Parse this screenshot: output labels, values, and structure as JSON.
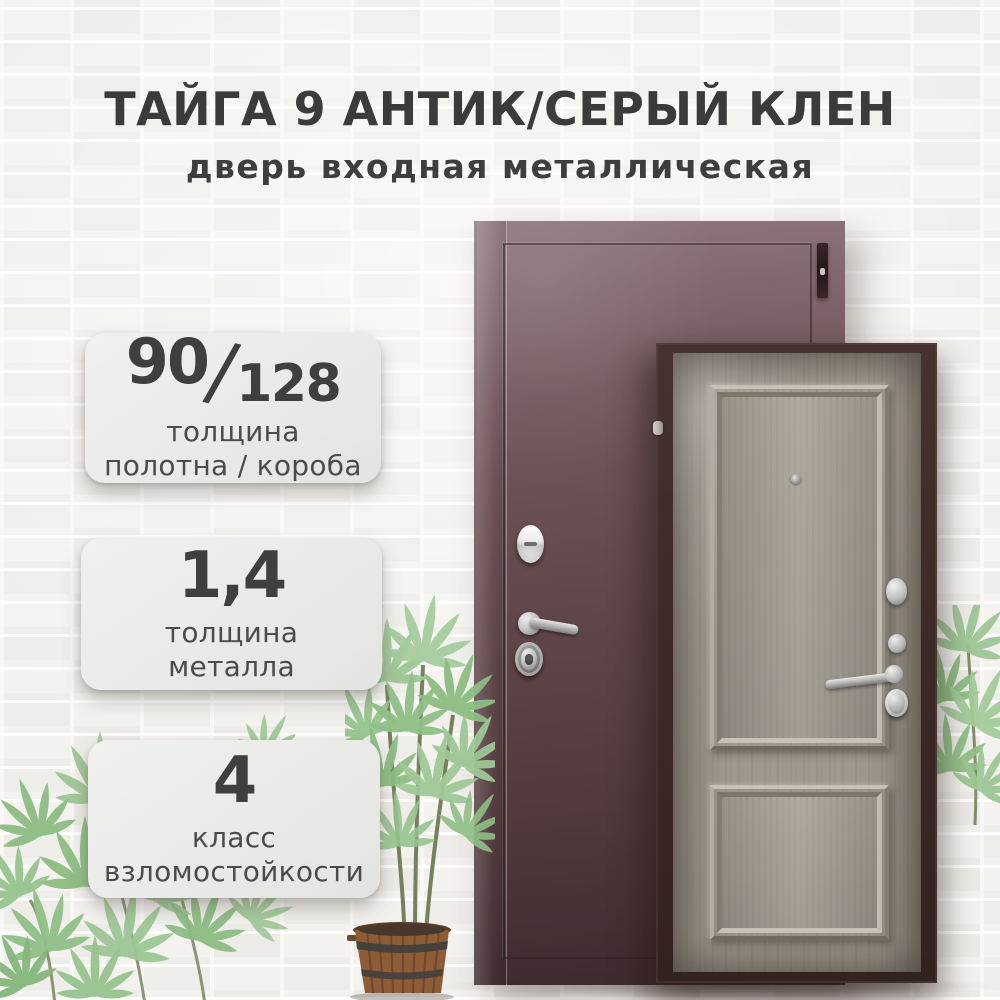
{
  "header": {
    "title": "ТАЙГА 9 АНТИК/СЕРЫЙ КЛЕН",
    "subtitle": "дверь входная металлическая"
  },
  "badges": [
    {
      "num_left": "90",
      "num_separator": "/",
      "num_right": "128",
      "label_line1": "толщина",
      "label_line2": "полотна / короба"
    },
    {
      "num": "1,4",
      "label_line1": "толщина",
      "label_line2": "металла"
    },
    {
      "num": "4",
      "label_line1": "класс",
      "label_line2": "взломостойкости"
    }
  ],
  "colors": {
    "title_text": "#3b3b3b",
    "badge_background": "#ebebea",
    "badge_text": "#4b4b4b",
    "exterior_door": "#5a4044",
    "interior_door": "#a39d91",
    "door_frame": "#3a2927",
    "wall": "#f2f0ed",
    "plant_green": "#9cc795",
    "barrel_brown": "#8f5c38"
  }
}
